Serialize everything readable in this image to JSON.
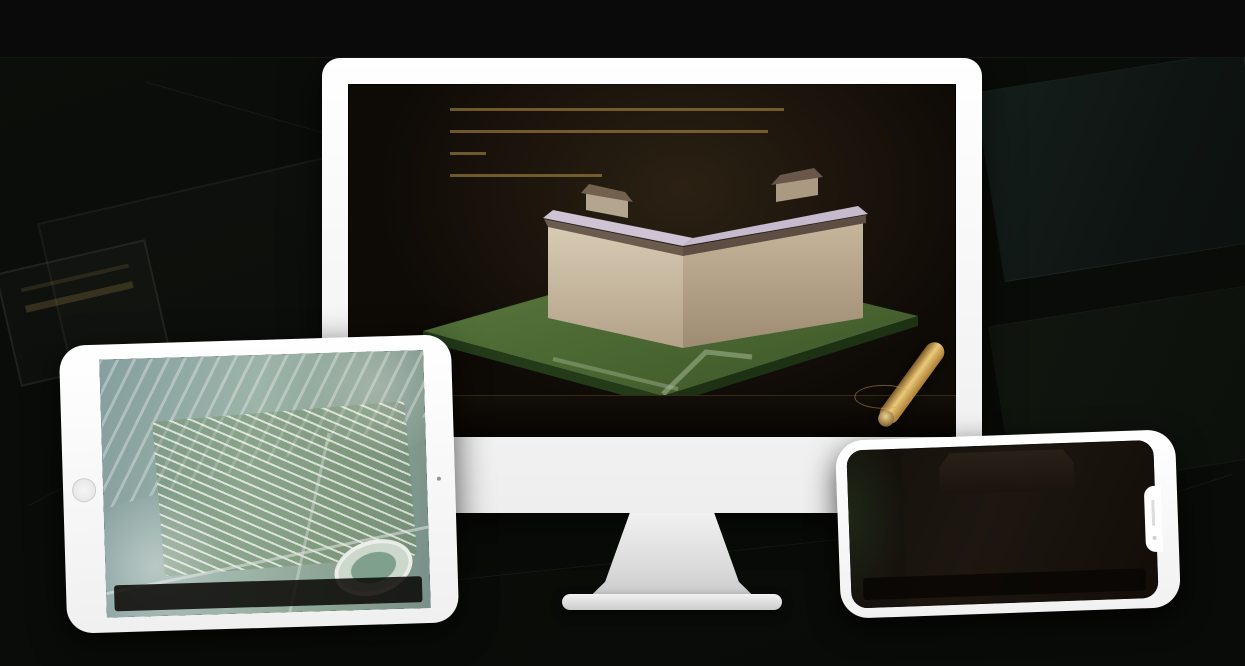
{
  "page": {
    "title": "VR互动售楼系统",
    "footnote": "*本项目涉及HVR互动体验系统大屏版、IPAD版及手机版"
  },
  "app": {
    "logo": "如·园",
    "nav_items": [
      "区位交通",
      "三维沙盘",
      "样板间VR",
      "户型鉴赏",
      "园林漫游",
      "项目鉴赏"
    ]
  },
  "monitor": {
    "unit_number": "20",
    "unit_suffix": "#楼",
    "section_title": "单体沙盘",
    "floor_buttons": [
      {
        "label": "3#楼",
        "active": false
      },
      {
        "label": "6#楼",
        "active": false
      },
      {
        "label": "8#楼",
        "active": false
      },
      {
        "label": "20#楼",
        "active": true
      }
    ],
    "sub_tabs": [
      {
        "label": "项目沙盘",
        "active": false
      },
      {
        "label": "单体沙盘",
        "active": true
      },
      {
        "label": "标准层",
        "active": false
      }
    ],
    "active_nav_index": 1
  },
  "ipad": {
    "sub_tabs": [
      {
        "label": "项目沙盘",
        "active": true
      },
      {
        "label": "单体沙盘",
        "active": false
      },
      {
        "label": "标准层",
        "active": false
      }
    ],
    "active_nav_index": 1
  },
  "phone": {
    "active_nav_index": 4,
    "panels": [
      {
        "top": "#b9bcb8",
        "bottom": "#6d6f6a"
      },
      {
        "top": "#4a5248",
        "bottom": "#232821"
      },
      {
        "top": "#8fb6c9",
        "bottom": "#5a7463"
      },
      {
        "top": "#c9b394",
        "bottom": "#6e5c43"
      },
      {
        "top": "#5a5e58",
        "bottom": "#2c2e2a"
      },
      {
        "top": "#b5762f",
        "bottom": "#5e3a14"
      }
    ]
  },
  "colors": {
    "gold": "#C9A25E",
    "gold_bright": "#ECC978",
    "active_fill": "#C59A4E",
    "screen_bg": "#0E0A06"
  }
}
